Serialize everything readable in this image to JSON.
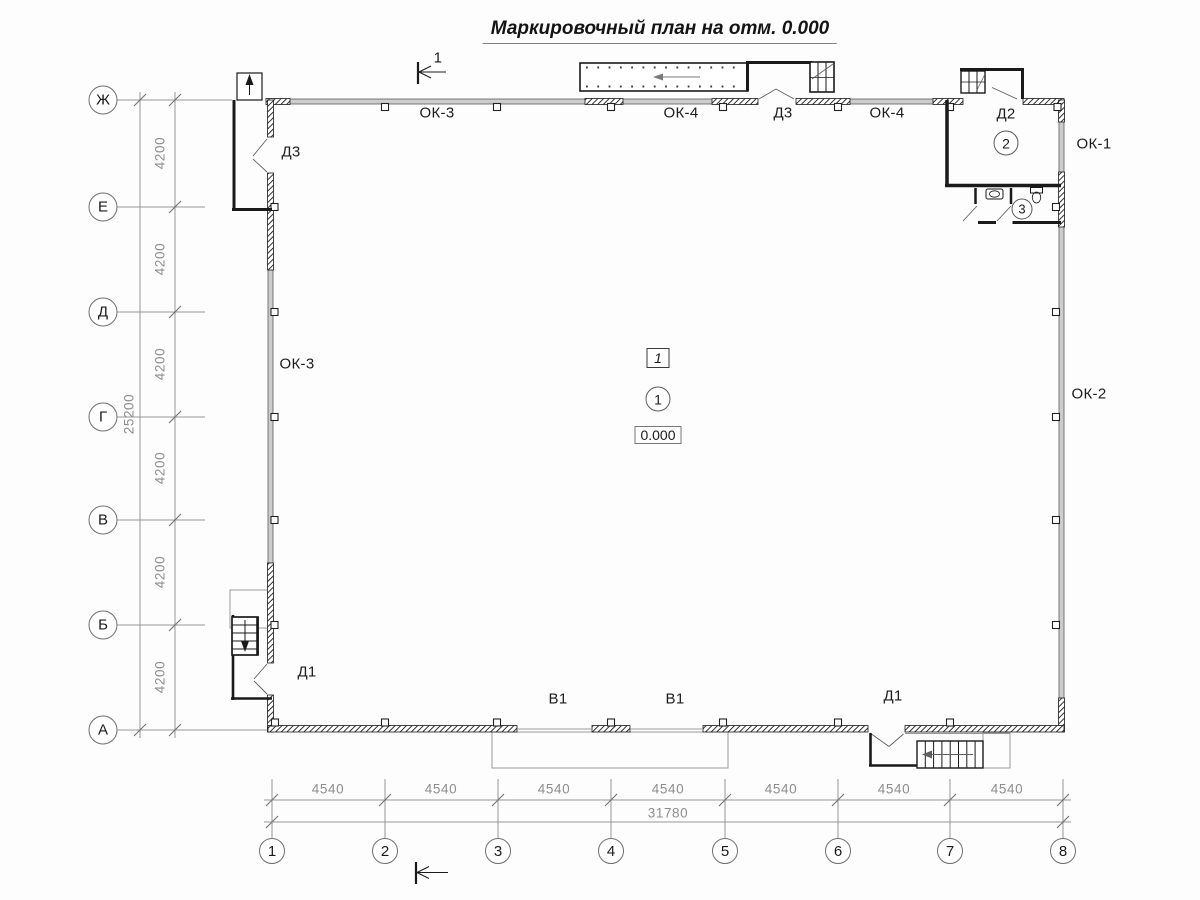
{
  "title": "Маркировочный план на отм. 0.000",
  "section_mark": "1",
  "axes": {
    "rows": [
      "Ж",
      "Е",
      "Д",
      "Г",
      "В",
      "Б",
      "А"
    ],
    "cols": [
      "1",
      "2",
      "3",
      "4",
      "5",
      "6",
      "7",
      "8"
    ]
  },
  "dimensions": {
    "bay_vertical": "4200",
    "total_vertical": "25200",
    "bay_horizontal": "4540",
    "total_horizontal": "31780"
  },
  "openings": {
    "ok1": "ОК-1",
    "ok2": "ОК-2",
    "ok3": "ОК-3",
    "ok4": "ОК-4",
    "d1": "Д1",
    "d2": "Д2",
    "d3": "Д3",
    "v1": "В1"
  },
  "rooms": {
    "hall_box": "1",
    "hall_circle": "1",
    "level": "0.000",
    "room2": "2",
    "room3": "3"
  }
}
